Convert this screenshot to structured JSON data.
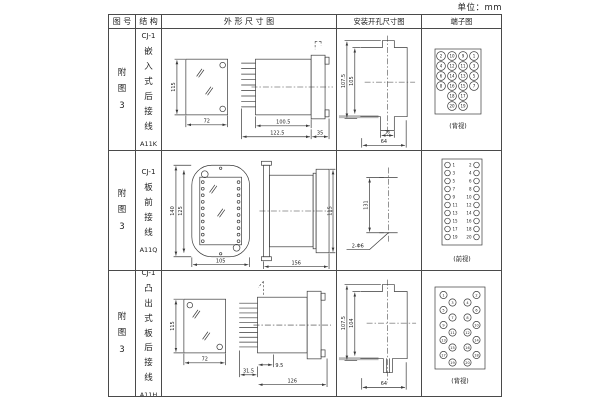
{
  "unit_label": "单位：mm",
  "headers": {
    "fig_no": "图 号",
    "structure": "结 构",
    "outline": "外 形 尺 寸 图",
    "install": "安装开孔尺寸图",
    "terminal": "端子图"
  },
  "rows": [
    {
      "fig_no": "附图3",
      "structure": {
        "model": "CJ-1",
        "desc": "嵌入式后接线",
        "code": "A11K"
      },
      "outline": {
        "front_height": "115",
        "front_width": "72",
        "body_len": "100.5",
        "total_len": "122.5",
        "flange_len": "35"
      },
      "install": {
        "outer_height": "107.5",
        "inner_height": "105",
        "slot_width": "16",
        "opening_width": "64"
      },
      "terminal": {
        "view": "(背视)",
        "numbers": [
          "2",
          "10",
          "9",
          "1",
          "4",
          "12",
          "11",
          "3",
          "6",
          "14",
          "13",
          "5",
          "8",
          "16",
          "15",
          "7",
          "18",
          "17",
          "20",
          "19"
        ]
      }
    },
    {
      "fig_no": "附图3",
      "structure": {
        "model": "CJ-1",
        "desc": "板前接线",
        "code": "A11Q"
      },
      "outline": {
        "outer_height": "140",
        "inner_height": "125",
        "width": "105",
        "side_length": "156",
        "side_height": "115"
      },
      "install": {
        "hole_spacing": "131",
        "holes": "2-Φ6"
      },
      "terminal": {
        "view": "(前视)",
        "left": [
          "1",
          "3",
          "5",
          "7",
          "9",
          "11",
          "13",
          "15",
          "17",
          "19"
        ],
        "right": [
          "2",
          "4",
          "6",
          "8",
          "10",
          "12",
          "14",
          "16",
          "18",
          "20"
        ]
      }
    },
    {
      "fig_no": "附图3",
      "structure": {
        "model": "CJ-1",
        "desc": "凸出式板后接线",
        "code": "A11H"
      },
      "outline": {
        "front_height": "115",
        "front_width": "72",
        "pin_len": "31.5",
        "lip_len": "9.5",
        "total_len": "126"
      },
      "install": {
        "outer_height": "107.5",
        "inner_height": "104",
        "opening_width": "64"
      },
      "terminal": {
        "view": "(背视)",
        "left": [
          "1",
          "3",
          "5",
          "7",
          "9",
          "11",
          "13",
          "15",
          "17",
          "19"
        ],
        "right": [
          "2",
          "4",
          "6",
          "8",
          "10",
          "12",
          "14",
          "16",
          "18",
          "20"
        ]
      }
    }
  ]
}
